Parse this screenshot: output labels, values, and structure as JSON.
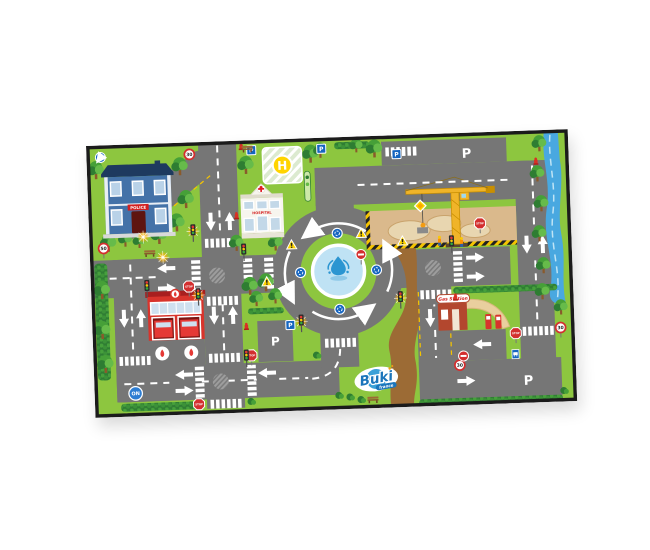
{
  "image": {
    "kind": "product photo of a children's city road play mat",
    "background": "#ffffff",
    "mat_rotation_deg": -2
  },
  "brand": {
    "name": "Buki",
    "suffix": "france"
  },
  "labels": {
    "parking": "P",
    "helipad": "H",
    "stop": "STOP",
    "on_button": "ON",
    "police": "POLICE",
    "hospital": "HOSPITAL",
    "gas_station": "Gas Station",
    "speed_limit_30": "30",
    "speed_limit_50": "50"
  },
  "colors": {
    "grass": "#8dc63f",
    "road": "#767676",
    "road_marking": "#ffffff",
    "water": "#49a8e0",
    "sand": "#dab98c",
    "dirt_path": "#9c6b35",
    "crane_yellow": "#f0b429",
    "sign_blue": "#1565c0",
    "sign_red": "#d32f2f",
    "helipad_yellow": "#ffd400",
    "hedge_green": "#2f7d33",
    "mat_edge": "#1b1b1b"
  },
  "features": [
    "police-station",
    "hospital",
    "helipad",
    "roundabout-with-fountain",
    "construction-site",
    "tower-crane",
    "river",
    "fire-station",
    "gas-station",
    "parking-areas",
    "pedestrian-crossings",
    "traffic-lights",
    "road-signs",
    "trees-and-hedges",
    "dirt-path",
    "brand-logo",
    "on-button"
  ]
}
